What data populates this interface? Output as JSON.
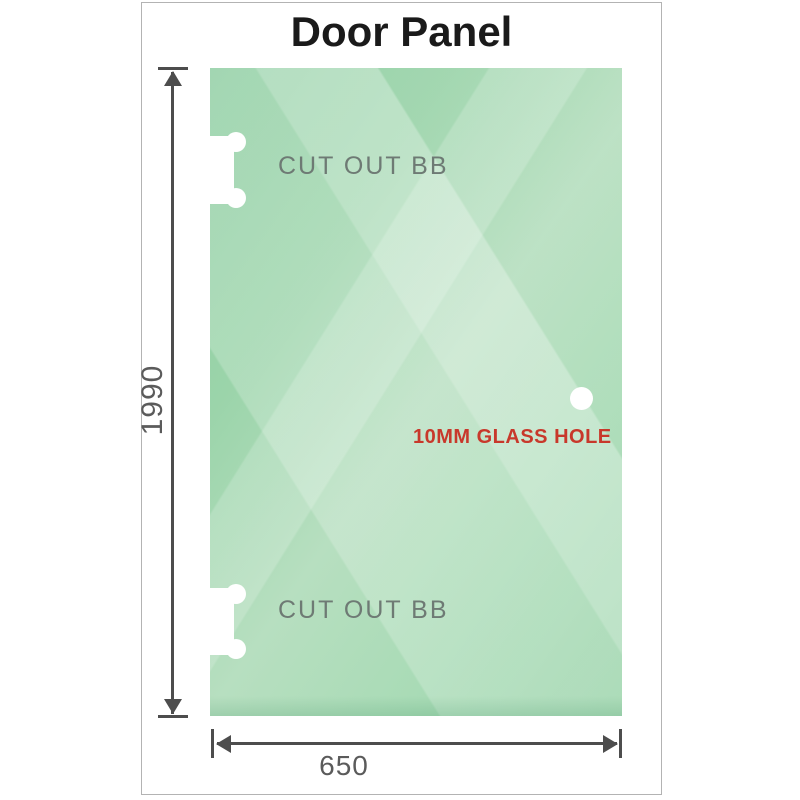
{
  "page": {
    "title": "Door Panel"
  },
  "diagram": {
    "cutout_label_top": "CUT OUT BB",
    "cutout_label_bottom": "CUT OUT BB",
    "hole_label": "10MM GLASS HOLE",
    "height_dimension": "1990",
    "width_dimension": "650"
  },
  "colors": {
    "glass_green_dark": "#8bcc9f",
    "glass_green_mid": "#9bd4aa",
    "glass_green_light": "#c2e5cb",
    "dimension_gray": "#4d4d4d",
    "label_gray": "#6e7a74",
    "hole_label_red": "#c8382b",
    "title_black": "#1a1a1a",
    "frame_border_gray": "#b3b3b3"
  }
}
